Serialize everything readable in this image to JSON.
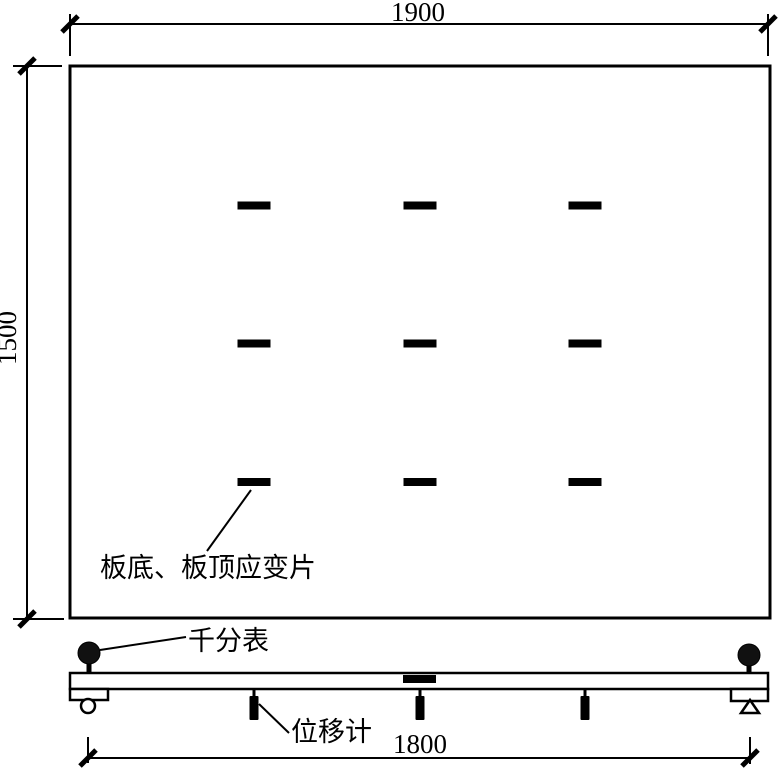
{
  "diagram": {
    "background": "#ffffff",
    "line_color": "#000000",
    "dimensions": {
      "top": "1900",
      "left": "1500",
      "bottom": "1800"
    },
    "labels": {
      "strain_gauges": "板底、板顶应变片",
      "dial_indicator": "千分表",
      "displacement_meter": "位移计"
    },
    "strain_gauge_grid": {
      "rows": 3,
      "columns": 3
    }
  }
}
